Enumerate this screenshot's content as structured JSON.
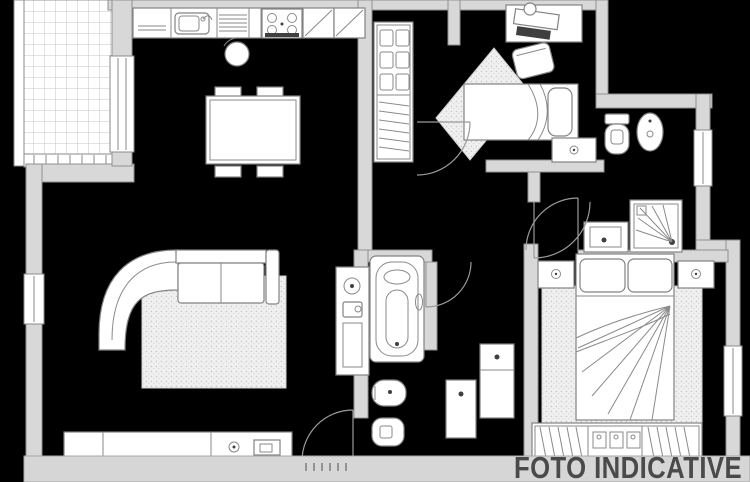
{
  "watermark": {
    "text": "FOTO INDICATIVE"
  },
  "colors": {
    "background": "#000000",
    "wall_fill": "#d8d8d8",
    "wall_stroke": "#8f8f8f",
    "furniture_fill": "#ffffff",
    "line": "#8a8a8a",
    "rug_fill": "#f0f0f0",
    "watermark_band": "#d6d6d6",
    "watermark_text": "#4a4a4a"
  },
  "floor_plan": {
    "type": "apartment-floor-plan",
    "rooms": [
      {
        "name": "balcony",
        "features": [
          "tiled-floor",
          "railing",
          "balcony-door"
        ]
      },
      {
        "name": "living-room",
        "features": [
          "kitchen-counter",
          "kitchen-sink",
          "stove",
          "upper-cabinets",
          "stool",
          "dining-table",
          "chairs",
          "sectional-sofa",
          "rug",
          "sideboard",
          "laundry-cabinet"
        ]
      },
      {
        "name": "entry-hall",
        "features": [
          "wardrobe",
          "coat-hangers",
          "storage-boxes",
          "doormat-rug"
        ]
      },
      {
        "name": "bedroom-2",
        "features": [
          "single-bed",
          "pillow",
          "desk",
          "desk-chair",
          "nightstand",
          "rug"
        ]
      },
      {
        "name": "bathroom-2",
        "features": [
          "toilet",
          "bidet",
          "shower",
          "washbasin",
          "window"
        ]
      },
      {
        "name": "bathroom-1",
        "features": [
          "bathtub",
          "bidet",
          "toilet",
          "door"
        ]
      },
      {
        "name": "hallway",
        "features": [
          "cabinet",
          "console-cabinet"
        ]
      },
      {
        "name": "master-bedroom",
        "features": [
          "double-bed",
          "pillows",
          "nightstand-left",
          "nightstand-right",
          "rug",
          "wardrobe",
          "window"
        ]
      }
    ]
  }
}
